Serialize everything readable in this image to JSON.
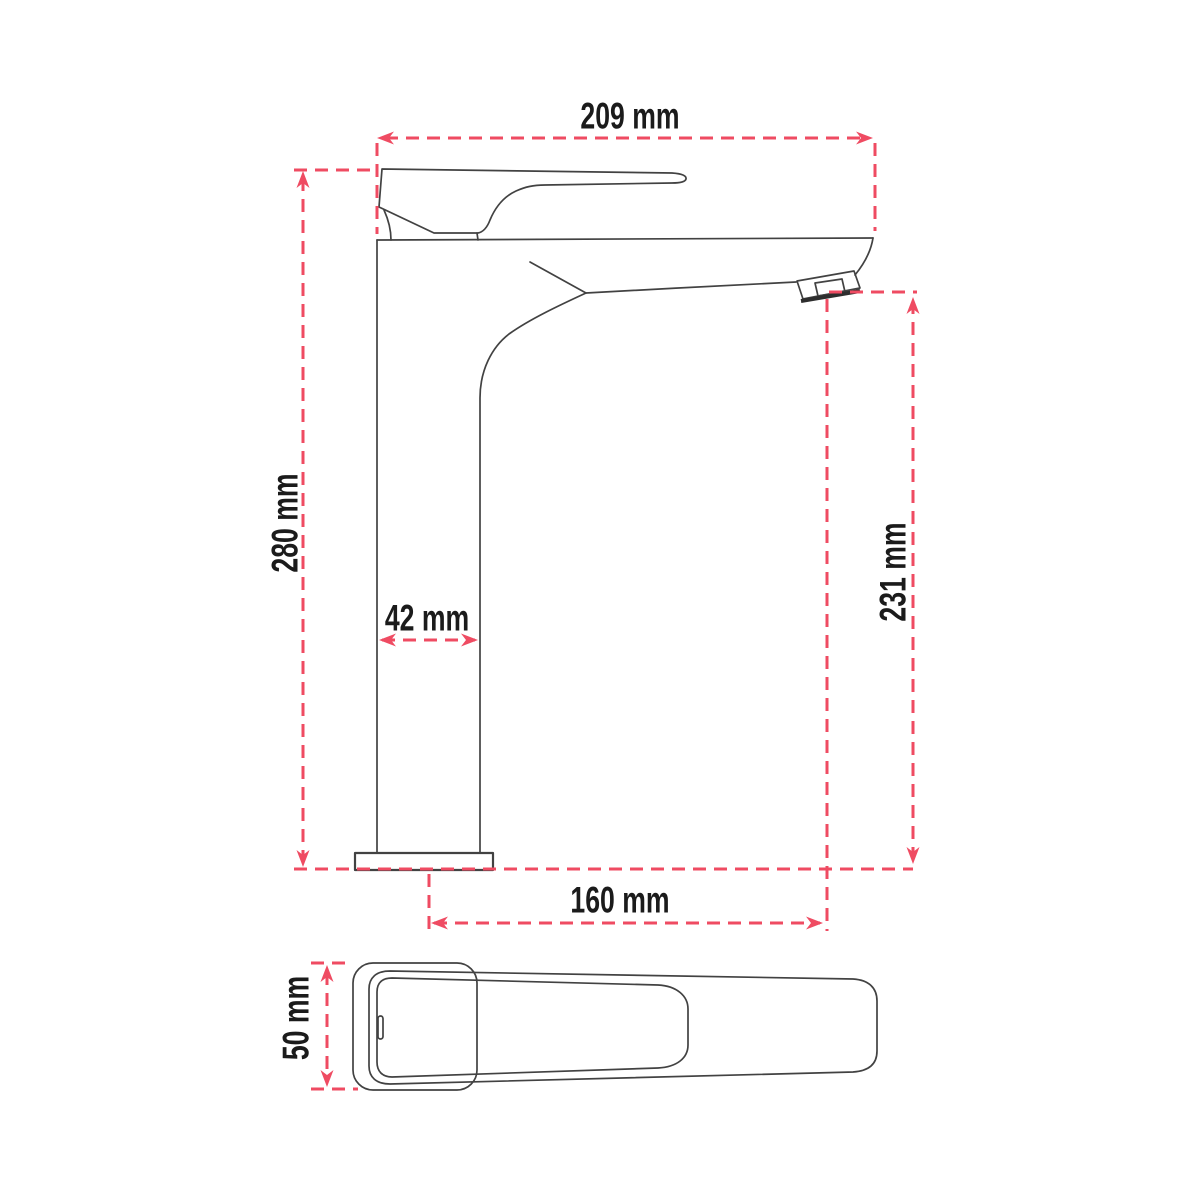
{
  "page": {
    "background": "#ffffff",
    "description": "Technical dimensional line drawing of a tall single-lever basin mixer tap: side view above, top view of handle below"
  },
  "drawing": {
    "unit": "mm",
    "colors": {
      "dimension_lines": "#ef4b62",
      "outline": "#424242",
      "label_text": "#1b1b1b"
    },
    "views": [
      {
        "id": "side-view",
        "name": "side view"
      },
      {
        "id": "top-view",
        "name": "top view"
      }
    ]
  },
  "dims": {
    "overall_width": {
      "value": 209,
      "unit": "mm",
      "label": "209 mm"
    },
    "overall_height": {
      "value": 280,
      "unit": "mm",
      "label": "280 mm"
    },
    "body_width": {
      "value": 42,
      "unit": "mm",
      "label": "42 mm"
    },
    "spout_height": {
      "value": 231,
      "unit": "mm",
      "label": "231 mm"
    },
    "spout_reach": {
      "value": 160,
      "unit": "mm",
      "label": "160 mm"
    },
    "handle_depth": {
      "value": 50,
      "unit": "mm",
      "label": "50 mm"
    }
  }
}
